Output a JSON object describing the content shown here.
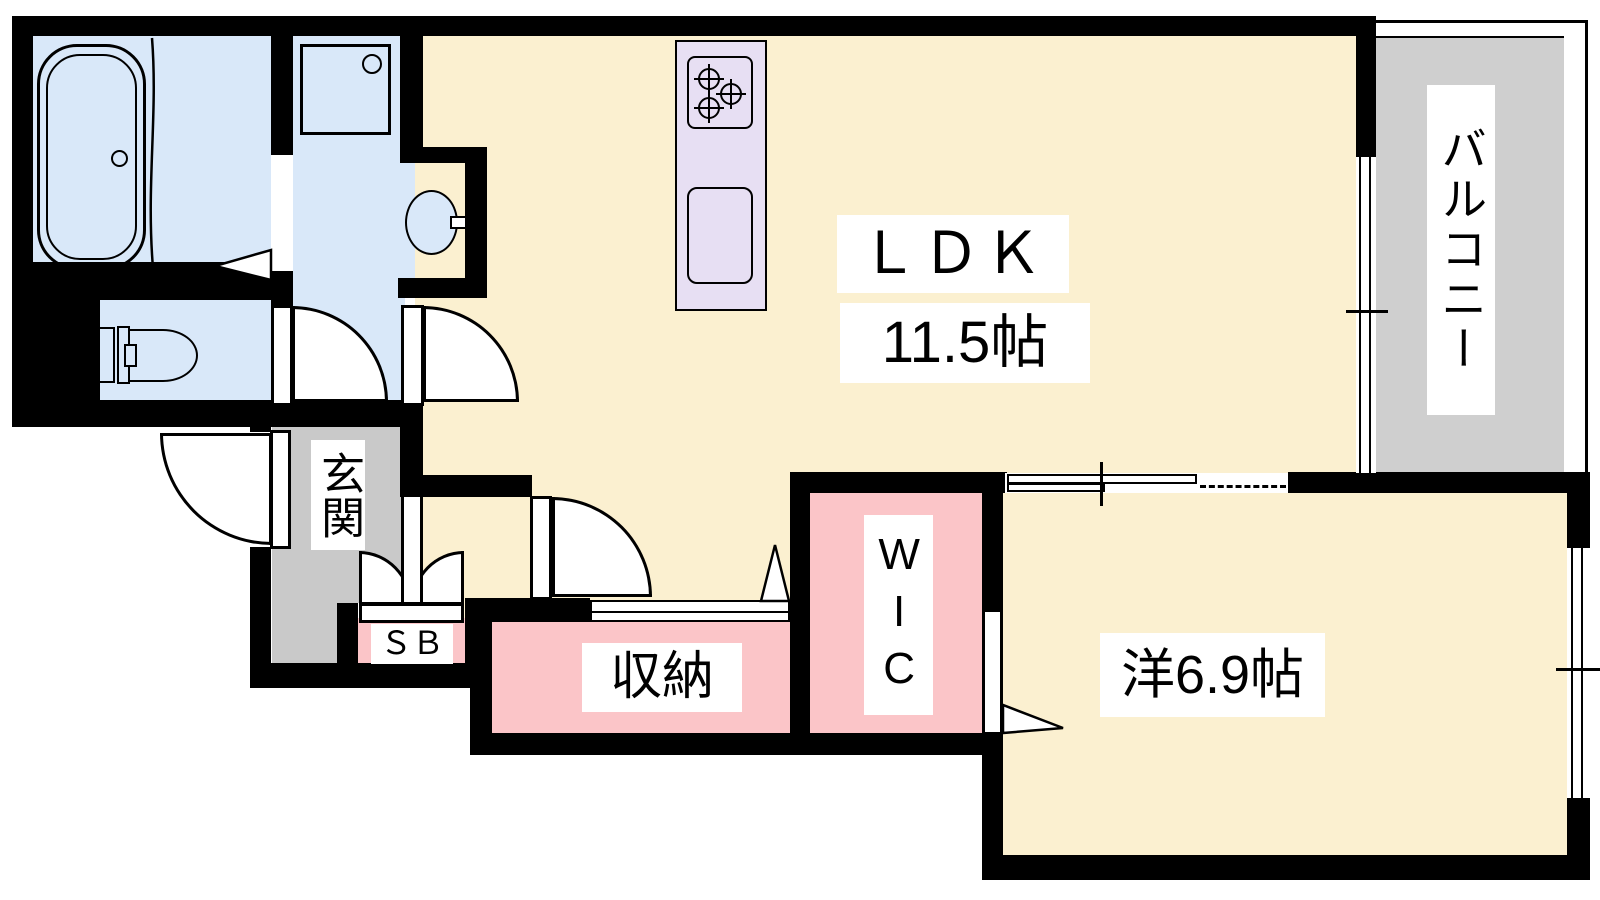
{
  "rooms": {
    "ldk": {
      "label": "ＬＤＫ",
      "size": "11.5帖"
    },
    "western": {
      "label": "洋6.9帖"
    },
    "balcony": {
      "label": "バルコニー"
    },
    "entrance": {
      "label": "玄関"
    },
    "storage": {
      "label": "収納"
    },
    "wic": {
      "label": "WIC"
    },
    "shoe_box": {
      "label": "ＳＢ"
    }
  },
  "colors": {
    "floor_cream": "#FBF0D0",
    "wet_area_blue": "#D9E8F9",
    "closet_pink": "#FBC5C8",
    "entrance_gray": "#C9C9C9",
    "balcony_gray": "#CFCFCF",
    "kitchen_lavender": "#E7DFF3",
    "wall_black": "#000000"
  }
}
